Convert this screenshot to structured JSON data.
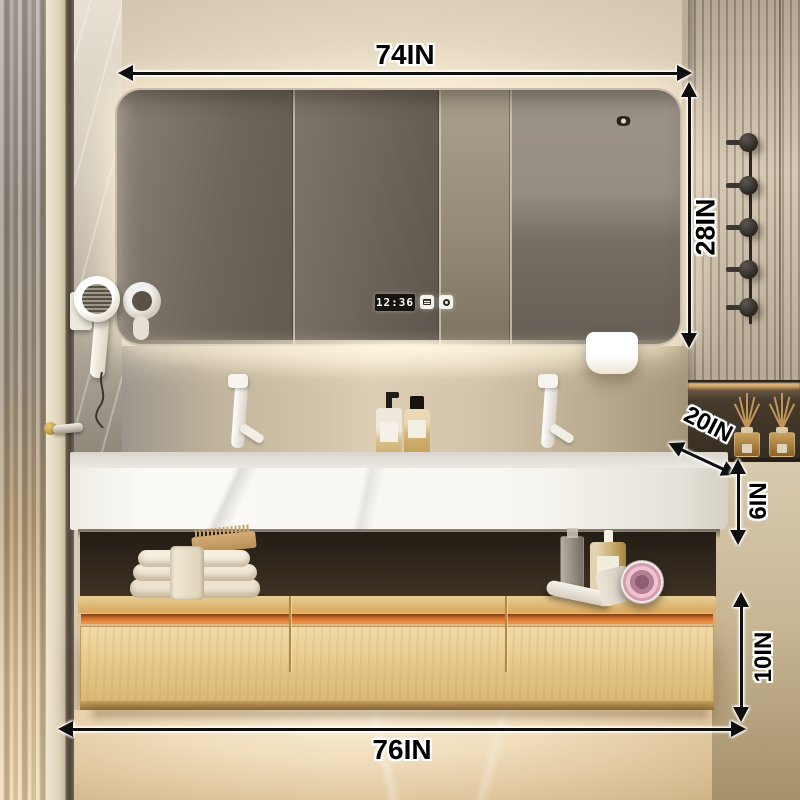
{
  "annotations": {
    "width_top": {
      "label": "74IN"
    },
    "mirror_height": {
      "label": "28IN"
    },
    "counter_depth": {
      "label": "20IN"
    },
    "counter_thickness": {
      "label": "6IN"
    },
    "drawer_height": {
      "label": "10IN"
    },
    "width_bottom": {
      "label": "76IN"
    }
  },
  "mirror_cabinet": {
    "clock_time": "12:36",
    "door_count": 4,
    "touch_icons": [
      "defog-icon",
      "power-icon"
    ]
  },
  "fixtures": {
    "wall_hook_count": 5,
    "reed_diffuser_count": 2,
    "faucet_count": 2,
    "drawer_count": 3
  },
  "objects": [
    "glass-door",
    "door-handle",
    "marble-wall",
    "wall-hair-dryer",
    "mirror-cabinet",
    "led-clock",
    "hanging-towel",
    "white-faucets",
    "soap-pump-bottles",
    "marble-countertop",
    "towel-stack",
    "wood-brush",
    "glass-bottle",
    "lotion-bottle",
    "pink-hair-dryer",
    "slat-panel",
    "wall-hooks",
    "reed-diffusers",
    "wood-drawer-cabinet",
    "marble-floor"
  ],
  "colors": {
    "arrow": "#0f0f0f",
    "label_outline": "#ffffff",
    "led_strip": "#e0812f",
    "wood": "#e7cd97",
    "countertop": "#f7f5f0",
    "wall": "#d8cbb6",
    "mirror_glass": "#6e665c"
  }
}
